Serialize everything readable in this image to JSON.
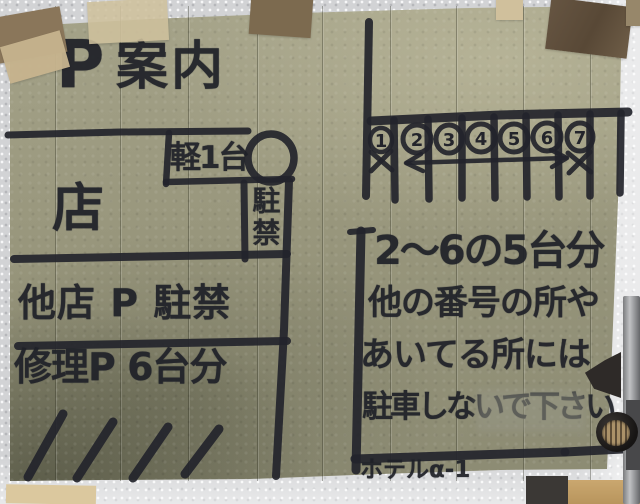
{
  "sign": {
    "title": {
      "p": "P",
      "annai": "案内"
    },
    "left_map": {
      "shop": "店",
      "kei_space": "軽1台",
      "no_parking_vertical": "駐禁",
      "row_other_shop": "他店 P 駐禁",
      "row_repair": "修理P 6台分"
    },
    "right_map": {
      "stall_numbers": [
        "1",
        "2",
        "3",
        "4",
        "5",
        "6",
        "7"
      ],
      "crossed_out": [
        "1",
        "7"
      ],
      "arrow_range": "2-6",
      "note_line1": "2〜6の5台分",
      "note_line2": "他の番号の所や",
      "note_line3": "あいてる所には",
      "note_line4": "駐車しないで下さい",
      "hotel": "ホテルα-1"
    },
    "colors": {
      "ink": "#23242b",
      "paper": "#98967c",
      "wall": "#d2d3d5",
      "tape": "#c9b890"
    }
  }
}
